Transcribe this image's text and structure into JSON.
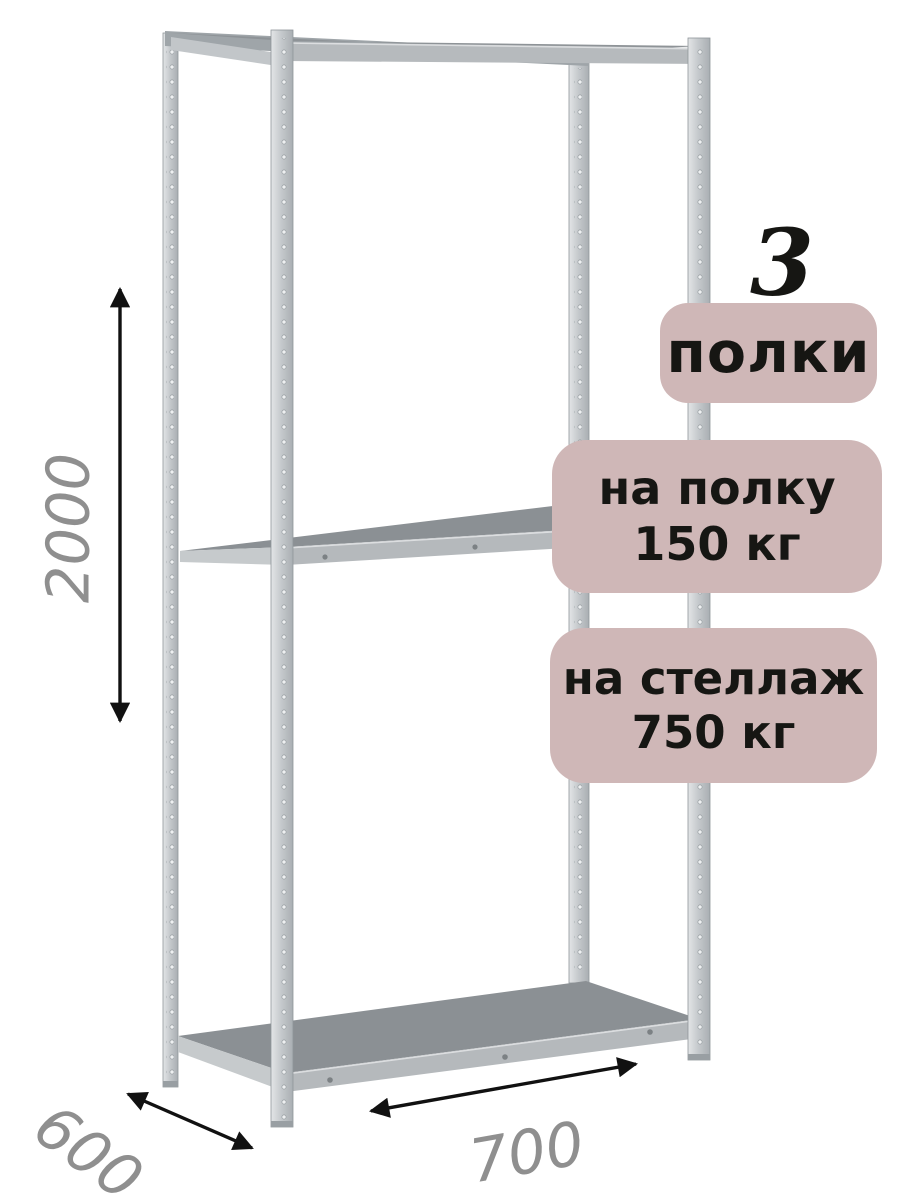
{
  "badges": {
    "count": "3",
    "count_label": "полки",
    "per_shelf": {
      "line1": "на полку",
      "line2": "150 кг"
    },
    "per_rack": {
      "line1": "на стеллаж",
      "line2": "750 кг"
    }
  },
  "dimensions": {
    "height": "2000",
    "depth": "600",
    "width": "700"
  },
  "colors": {
    "background": "#ffffff",
    "badge_bg": "#cfb7b7",
    "badge_text": "#161613",
    "dimension_text": "#8f8f8f",
    "arrow": "#111111",
    "metal_light": "#e3e5e7",
    "metal_mid": "#c6cacd",
    "metal_dark": "#a9aeb2",
    "shelf_top": "#8b9094",
    "shelf_front": "#b5b9bc"
  }
}
